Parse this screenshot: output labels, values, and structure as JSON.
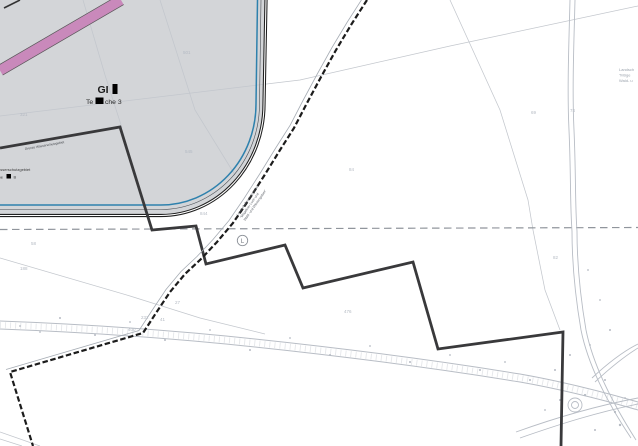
{
  "map": {
    "area": {
      "use_label": "GI",
      "sub_prefix": "Te",
      "sub_suffix": "che 3"
    },
    "labels": {
      "grenze_diag": "Grenze Wasserschutzgebiet",
      "left_line1": "asserschutzgebiet",
      "left_line2_pre": "ne",
      "left_line2_post": "B",
      "ls_diag_1": "Landschaftsschutzgebiet",
      "ls_diag_2": "\"Mögeliner Luch und",
      "ls_diag_3": "Wald- und Wiesengebiet\"",
      "ls_right_1": "Landsch",
      "ls_right_2": "\"Möge",
      "ls_right_3": "Wald- u",
      "l_marker": "L"
    },
    "parcel_numbers": [
      {
        "label": "501",
        "x": 183,
        "y": 54
      },
      {
        "label": "321",
        "x": 20,
        "y": 116
      },
      {
        "label": "545",
        "x": 185,
        "y": 153
      },
      {
        "label": "844",
        "x": 200,
        "y": 215
      },
      {
        "label": "84",
        "x": 349,
        "y": 171
      },
      {
        "label": "69",
        "x": 531,
        "y": 114
      },
      {
        "label": "74",
        "x": 570,
        "y": 112
      },
      {
        "label": "82",
        "x": 553,
        "y": 259
      },
      {
        "label": "476",
        "x": 344,
        "y": 313
      },
      {
        "label": "58",
        "x": 31,
        "y": 245
      },
      {
        "label": "188",
        "x": 20,
        "y": 270
      },
      {
        "label": "27",
        "x": 175,
        "y": 304
      },
      {
        "label": "232",
        "x": 141,
        "y": 319
      },
      {
        "label": "41",
        "x": 160,
        "y": 321
      },
      {
        "label": "400",
        "x": 128,
        "y": 331
      }
    ],
    "colors": {
      "area_fill": "#d3d5d8",
      "water_blue": "#2e81ad",
      "stripe_pink": "#c989bb",
      "boundary_black": "#1f1f1f",
      "step_gray": "#39393b",
      "faint_line": "#c3c7cd",
      "dashed_gray": "#90959c",
      "rail_gray": "#b8bdc5",
      "label_dark": "#333333",
      "label_gray": "#9aa2ac",
      "parcel_gray": "#b4bac3"
    }
  }
}
